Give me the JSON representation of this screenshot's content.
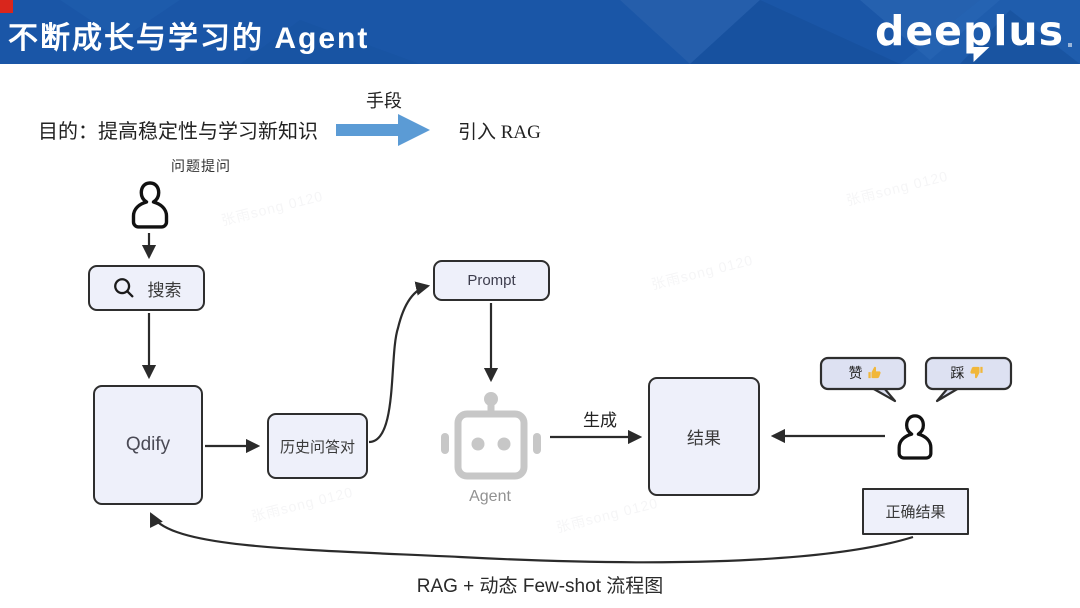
{
  "header": {
    "title": "不断成长与学习的 Agent",
    "logo_text": "deeplus",
    "bar_color": "#1a56a7",
    "corner_color": "#d9261c"
  },
  "intro": {
    "purpose_text": "目的：提高稳定性与学习新知识",
    "arrow_label": "手段",
    "result_text": "引入 RAG",
    "arrow_color": "#5b9bd5"
  },
  "diagram": {
    "question_label": "问题提问",
    "nodes": {
      "search": "搜索",
      "qdify": "Qdify",
      "history_qa": "历史问答对",
      "prompt": "Prompt",
      "result": "结果",
      "correct_result": "正确结果"
    },
    "agent_label": "Agent",
    "edge_labels": {
      "generate": "生成"
    },
    "feedback": {
      "like": "赞",
      "dislike": "踩"
    },
    "colors": {
      "node_fill": "#eef0fa",
      "node_border": "#2e2e2e",
      "robot_gray": "#c7c7c7",
      "thumb_yellow": "#f1b73a",
      "arrow": "#2b2b2b"
    }
  },
  "caption": "RAG + 动态 Few-shot 流程图",
  "watermark": {
    "text": "张雨song 0120"
  }
}
